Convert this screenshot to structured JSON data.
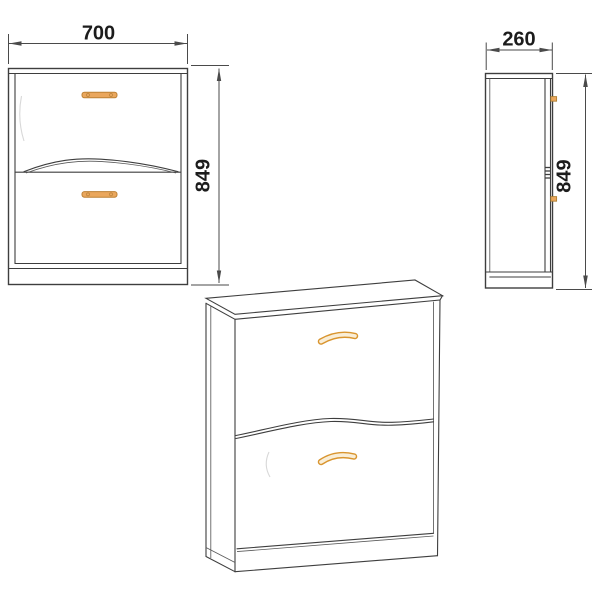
{
  "dimensions": {
    "front_width": "700",
    "front_height": "849",
    "side_depth": "260",
    "side_height": "849"
  },
  "colors": {
    "line": "#3e3e3e",
    "dimension_line": "#4a4a4a",
    "label_text": "#1c1c1c",
    "handle_fill": "#eaa75d",
    "handle_stroke": "#bd8134",
    "perspective_handle_stroke": "#d9952f",
    "perspective_handle_fill": "#f9eed7",
    "background": "#ffffff"
  }
}
